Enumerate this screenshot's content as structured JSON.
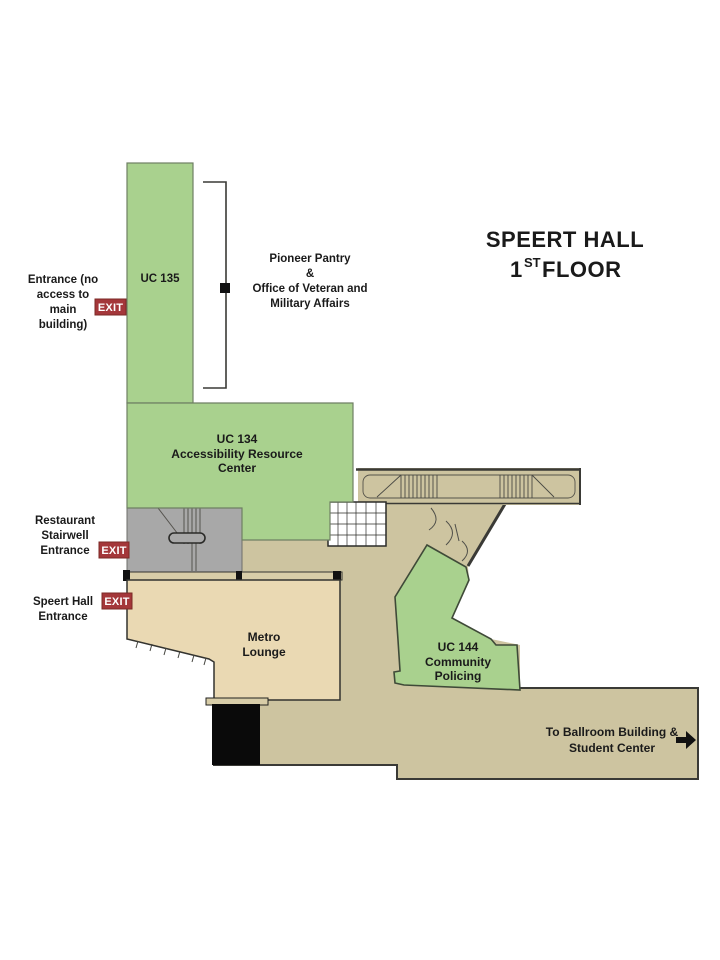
{
  "title": {
    "line1": "SPEERT HALL",
    "floor_num": "1",
    "floor_sup": "ST",
    "floor_rest": "FLOOR"
  },
  "exit_sign": "EXIT",
  "labels": {
    "entrance_no_access": {
      "lines": [
        "Entrance (no",
        "access to",
        "main",
        "building)"
      ]
    },
    "restaurant_stairwell": {
      "lines": [
        "Restaurant",
        "Stairwell",
        "Entrance"
      ]
    },
    "speert_entrance": {
      "lines": [
        "Speert Hall",
        "Entrance"
      ]
    },
    "pioneer_pantry": {
      "lines": [
        "Pioneer Pantry",
        "&",
        "Office of Veteran and",
        "Military Affairs"
      ]
    },
    "ballroom": {
      "lines": [
        "To Ballroom Building &",
        "Student Center"
      ]
    }
  },
  "rooms": {
    "uc135": {
      "name": "UC 135"
    },
    "uc134": {
      "lines": [
        "UC 134",
        "Accessibility Resource",
        "Center"
      ]
    },
    "metro_lounge": {
      "lines": [
        "Metro",
        "Lounge"
      ]
    },
    "uc144": {
      "lines": [
        "UC 144",
        "Community",
        "Policing"
      ]
    }
  },
  "colors": {
    "room_green": "#a9d18e",
    "lounge_tan": "#ead9b3",
    "corridor_tan": "#cdc4a0",
    "wall_tan": "#d8cda8",
    "stair_gray": "#a8a8a8",
    "exit_red": "#a4373a",
    "tile_white": "#ffffff",
    "opening_black": "#0a0a0a",
    "arrow_black": "#111111"
  }
}
